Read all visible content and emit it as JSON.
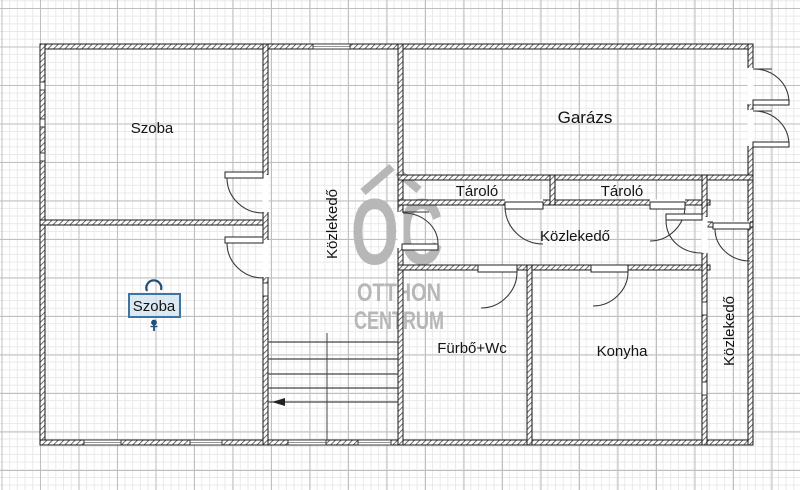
{
  "canvas": {
    "width": 800,
    "height": 490
  },
  "colors": {
    "grid_minor": "#e9e9e9",
    "grid_major": "#bfbfbf",
    "wall": "#1a1a1a",
    "label": "#141414",
    "watermark": "#b7b7b7",
    "selection_border": "#3c74a6",
    "selection_fill": "#cfe1f0",
    "selection_handle": "#1d4f79"
  },
  "plan": {
    "rooms": [
      {
        "key": "szoba_top",
        "label": "Szoba"
      },
      {
        "key": "szoba_bottom",
        "label": "Szoba",
        "selected": true
      },
      {
        "key": "kozlekedo_middle",
        "label": "Közlekedő"
      },
      {
        "key": "garazs",
        "label": "Garázs"
      },
      {
        "key": "tarolo_1",
        "label": "Tároló"
      },
      {
        "key": "tarolo_2",
        "label": "Tároló"
      },
      {
        "key": "kozlekedo_center",
        "label": "Közlekedő"
      },
      {
        "key": "furdo_wc",
        "label": "Fürbő+Wc"
      },
      {
        "key": "konyha",
        "label": "Konyha"
      },
      {
        "key": "kozlekedo_right",
        "label": "Közlekedő"
      }
    ]
  },
  "watermark": {
    "logo_text": "OC",
    "line1": "OTTHON",
    "line2": "CENTRUM"
  },
  "selection": {
    "selected_label": "Szoba"
  }
}
